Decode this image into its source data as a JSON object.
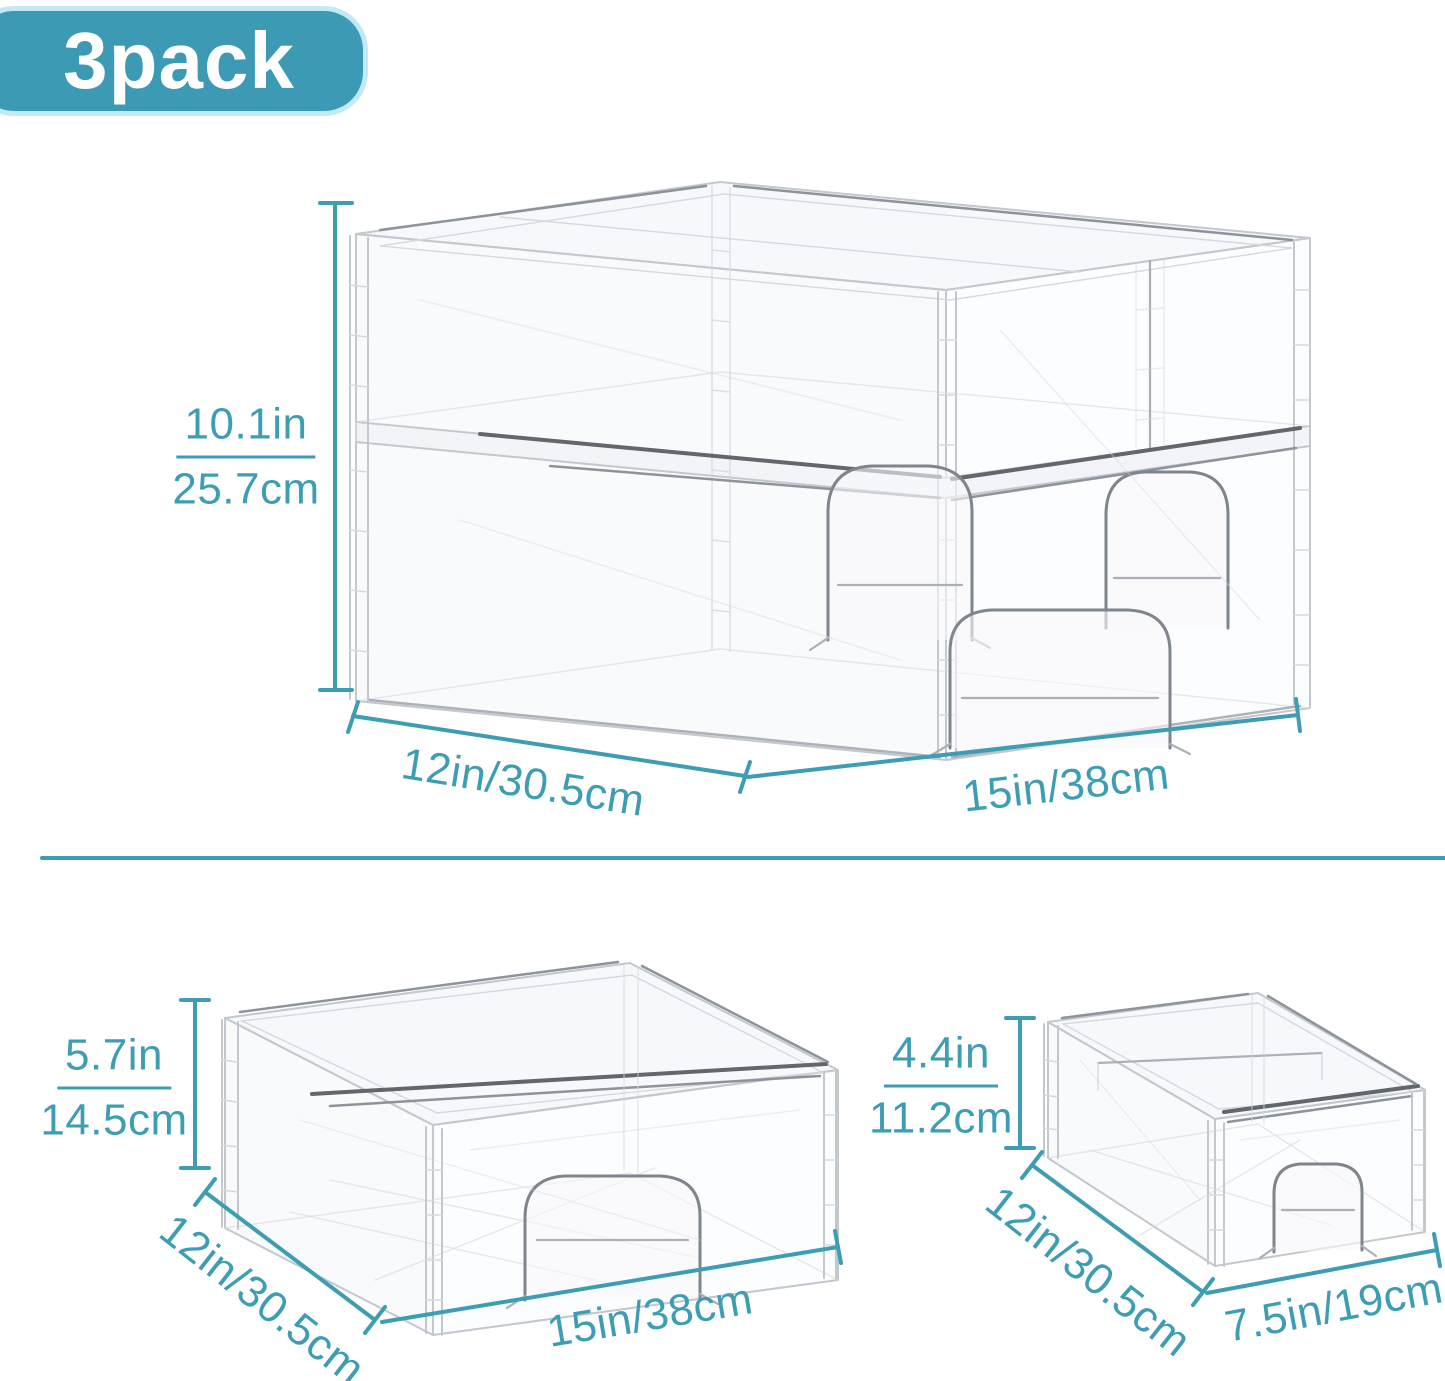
{
  "badge": {
    "label": "3pack"
  },
  "colors": {
    "accent": "#3c9db3",
    "badge_fill": "#3c9ab4",
    "badge_border": "#c2e9f4",
    "badge_text": "#ffffff",
    "wireframe_gray": "#c3c8cf"
  },
  "figures": {
    "stack": {
      "description": "two small drawers stacked on one large drawer",
      "height_in": "10.1in",
      "height_cm": "25.7cm",
      "depth_label": "12in/30.5cm",
      "width_label": "15in/38cm"
    },
    "large_drawer": {
      "description": "large single stackable drawer",
      "height_in": "5.7in",
      "height_cm": "14.5cm",
      "depth_label": "12in/30.5cm",
      "width_label": "15in/38cm"
    },
    "small_drawer": {
      "description": "small single stackable drawer",
      "height_in": "4.4in",
      "height_cm": "11.2cm",
      "depth_label": "12in/30.5cm",
      "width_label": "7.5in/19cm"
    }
  }
}
